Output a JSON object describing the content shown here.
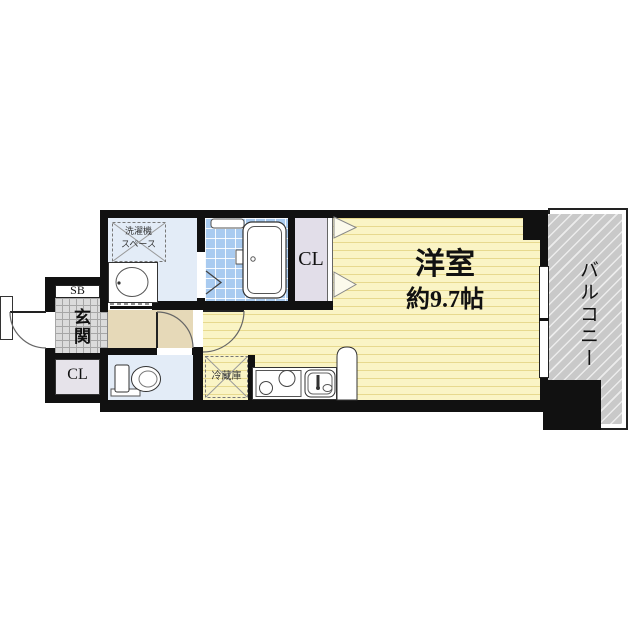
{
  "floorplan": {
    "labels": {
      "main_room_name": "洋室",
      "main_room_size": "約9.7帖",
      "balcony": "バルコニー",
      "closet_main": "CL",
      "closet_entrance": "CL",
      "shoe_box": "SB",
      "entrance": "玄関",
      "washer_line1": "洗濯機",
      "washer_line2": "スペース",
      "fridge": "冷蔵庫"
    },
    "colors": {
      "wall": "#111111",
      "main_room_floor": "#FAF4C5",
      "main_room_stripe": "#E7D98E",
      "wet_room_floor": "#E3ECF7",
      "bath_tile": "#A9CBF0",
      "closet_floor": "#E2DEE9",
      "hallway_floor": "#E6D9B8",
      "entrance_tile": "#DBDBDB",
      "balcony_floor": "#C9C9C9"
    },
    "fixtures": [
      "bathtub",
      "washbasin",
      "washing-machine-space",
      "toilet",
      "refrigerator-space",
      "two-burner-stove",
      "kitchen-sink",
      "balcony-window",
      "entrance-door",
      "room-door",
      "toilet-door",
      "folding-closet-doors",
      "folding-bath-door"
    ]
  }
}
